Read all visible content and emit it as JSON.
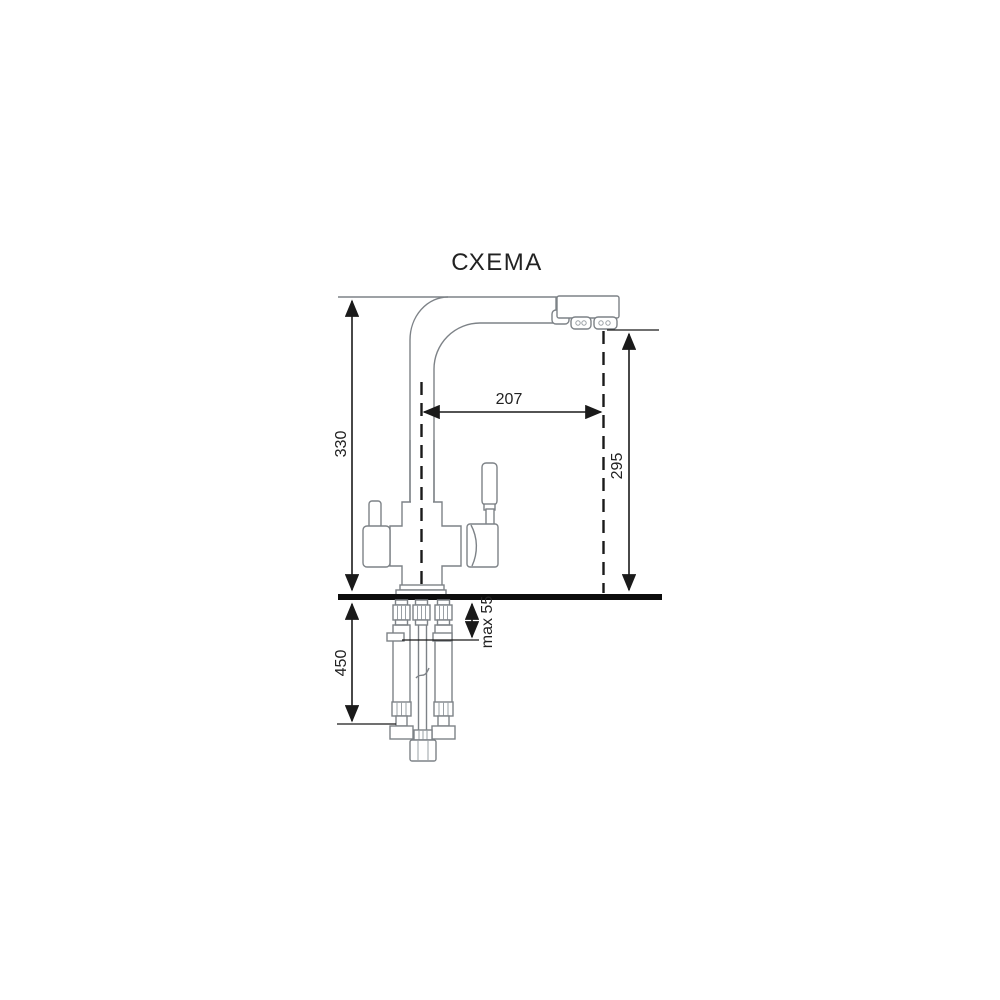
{
  "title": "СХЕМА",
  "dimensions": {
    "overall_height": "330",
    "spout_reach": "207",
    "spout_height": "295",
    "mount_max_thickness": "max 55",
    "under_counter_depth": "450"
  },
  "colors": {
    "title_gray": "#70767d",
    "dimension_black": "#1a1a1a",
    "faucet_outline_gray": "#7d8287",
    "countertop_black": "#0d0d0d",
    "background": "#ffffff"
  }
}
